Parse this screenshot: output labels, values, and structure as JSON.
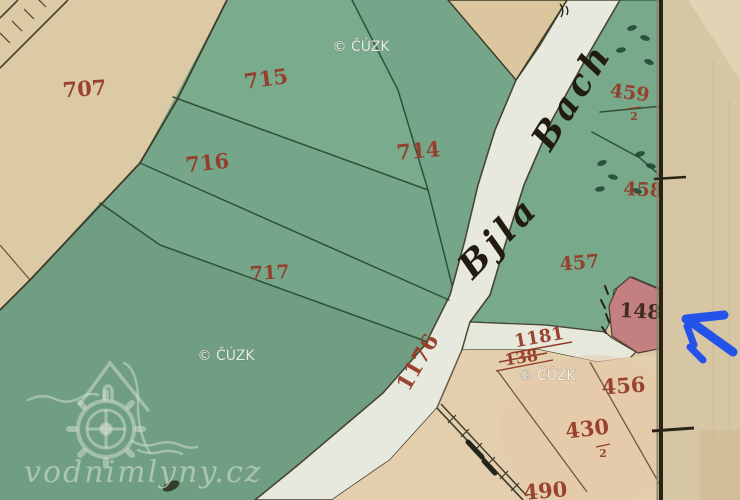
{
  "map": {
    "stream": {
      "name_part1": "Bjla",
      "name_part2": "Bach",
      "channel_number": "1176"
    },
    "parcels": {
      "p707": "707",
      "p715": "715",
      "p716": "716",
      "p714": "714",
      "p717": "717",
      "p459": "459",
      "p459_sub": "2",
      "p458": "458",
      "p457": "457",
      "p148": "148",
      "p1181": "1181",
      "p138": "138",
      "p456": "456",
      "p430": "430",
      "p430_sub": "2",
      "p490": "490"
    },
    "colors": {
      "parcel_number_red": "#953c28",
      "green_field": "#76a689",
      "green_field_bright": "#7aab8d",
      "stream_white": "#e7e9de",
      "beige_paper": "#dccaa5",
      "beige_bottom": "#e3ceae",
      "pink_parcel": "#c28180",
      "map_border_dark": "#262317",
      "arrow_blue": "#2353e8",
      "watermark_white": "#ffffff"
    }
  },
  "watermark": {
    "text": "© ČÚZK"
  },
  "logo": {
    "text": "vodnimlyny.cz"
  },
  "annotation": {
    "arrow_color": "#2353e8"
  }
}
